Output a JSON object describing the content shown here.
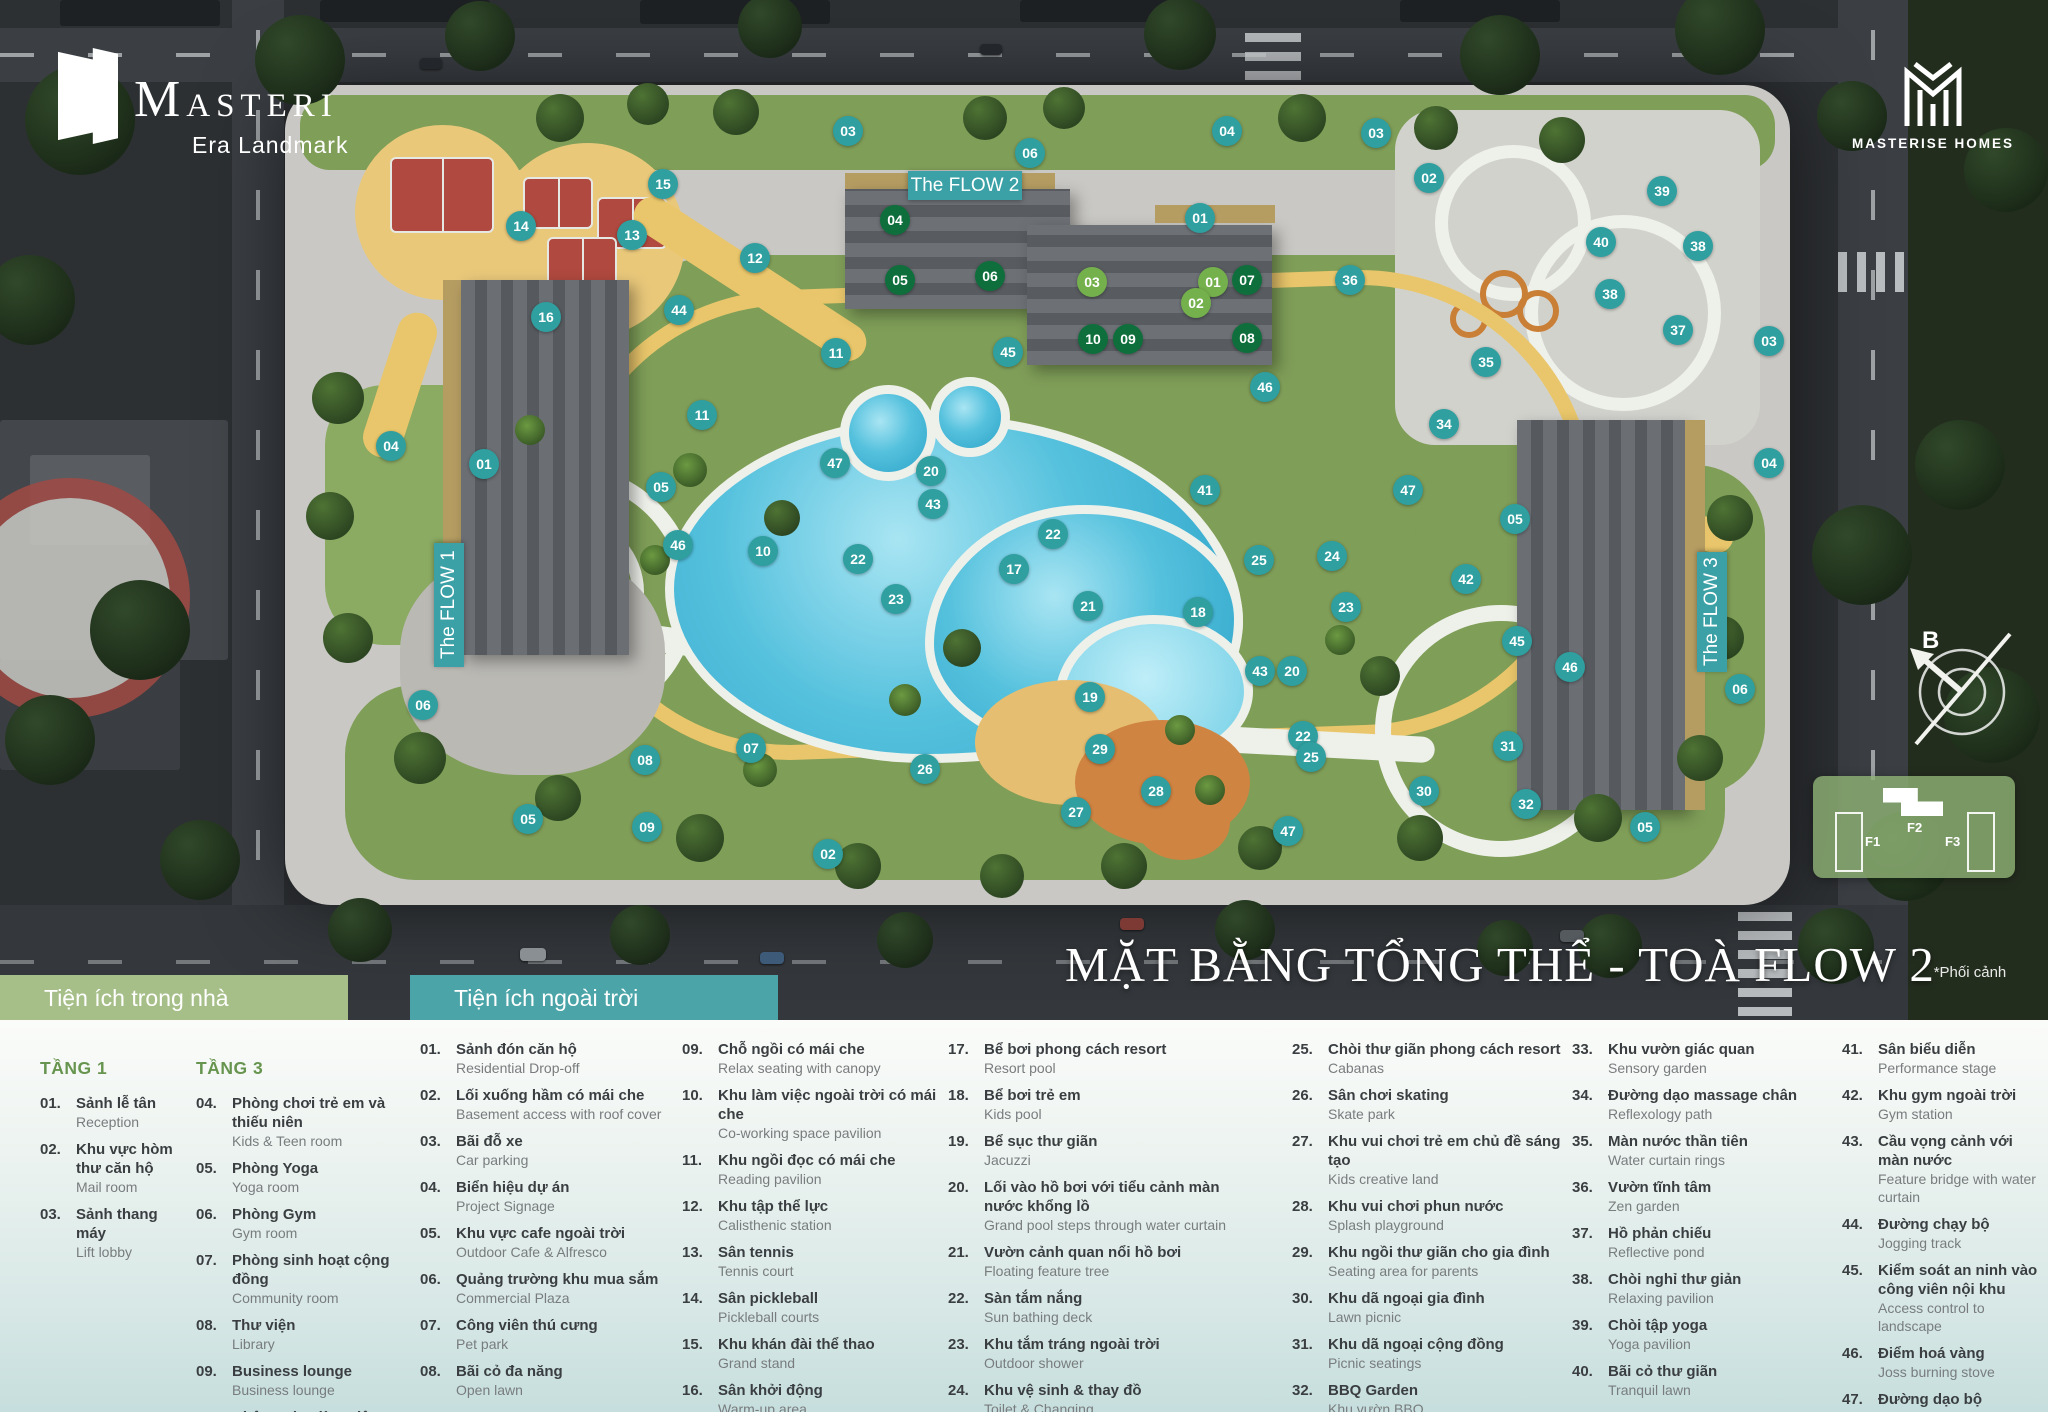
{
  "branding": {
    "logo_title": "MASTERI",
    "logo_subtitle": "Era Landmark",
    "developer": "MASTERISE HOMES"
  },
  "title": "MẶT BẰNG TỔNG THỂ - TOÀ FLOW 2",
  "note": "*Phối cảnh",
  "compass_label": "B",
  "tower_labels": {
    "flow1": "The FLOW 1",
    "flow2": "The FLOW 2",
    "flow3": "The FLOW 3"
  },
  "locator": {
    "f1": "F1",
    "f2": "F2",
    "f3": "F3"
  },
  "colors": {
    "marker_teal": "#2f9fa0",
    "marker_green_floor1": "#74b04c",
    "marker_green_floor3": "#0f6f3c",
    "header_green": "#a6bf88",
    "header_teal": "#4aa4a8"
  },
  "legend": {
    "indoor_header": "Tiện ích trong nhà",
    "outdoor_header": "Tiện ích ngoài trời",
    "floor1_title": "TẦNG 1",
    "floor3_title": "TẦNG 3",
    "floor1_items": [
      {
        "no": "01.",
        "vi": "Sảnh lễ tân",
        "en": "Reception"
      },
      {
        "no": "02.",
        "vi": "Khu vực hòm thư căn hộ",
        "en": "Mail room"
      },
      {
        "no": "03.",
        "vi": "Sảnh thang máy",
        "en": "Lift lobby"
      }
    ],
    "floor3_items": [
      {
        "no": "04.",
        "vi": "Phòng chơi trẻ em và thiếu niên",
        "en": "Kids & Teen room"
      },
      {
        "no": "05.",
        "vi": "Phòng Yoga",
        "en": "Yoga room"
      },
      {
        "no": "06.",
        "vi": "Phòng Gym",
        "en": "Gym room"
      },
      {
        "no": "07.",
        "vi": "Phòng sinh hoạt cộng đồng",
        "en": "Community room"
      },
      {
        "no": "08.",
        "vi": "Thư viện",
        "en": "Library"
      },
      {
        "no": "09.",
        "vi": "Business lounge",
        "en": "Business lounge"
      },
      {
        "no": "10.",
        "vi": "Không gian làm việc",
        "en": "Co-working space"
      }
    ],
    "outdoor_columns": [
      [
        {
          "no": "01.",
          "vi": "Sảnh đón căn hộ",
          "en": "Residential Drop-off"
        },
        {
          "no": "02.",
          "vi": "Lối xuống hầm có mái che",
          "en": "Basement access with roof cover"
        },
        {
          "no": "03.",
          "vi": "Bãi đỗ xe",
          "en": "Car parking"
        },
        {
          "no": "04.",
          "vi": "Biển hiệu dự án",
          "en": "Project Signage"
        },
        {
          "no": "05.",
          "vi": "Khu vực cafe ngoài trời",
          "en": "Outdoor Cafe & Alfresco"
        },
        {
          "no": "06.",
          "vi": "Quảng trường khu mua sắm",
          "en": "Commercial Plaza"
        },
        {
          "no": "07.",
          "vi": "Công viên thú cưng",
          "en": "Pet park"
        },
        {
          "no": "08.",
          "vi": "Bãi cỏ đa năng",
          "en": "Open lawn"
        }
      ],
      [
        {
          "no": "09.",
          "vi": "Chỗ ngồi có mái che",
          "en": "Relax seating with canopy"
        },
        {
          "no": "10.",
          "vi": "Khu làm việc ngoài trời có mái che",
          "en": "Co-working space pavilion"
        },
        {
          "no": "11.",
          "vi": "Khu ngồi đọc có mái che",
          "en": "Reading pavilion"
        },
        {
          "no": "12.",
          "vi": "Khu tập thể lực",
          "en": "Calisthenic station"
        },
        {
          "no": "13.",
          "vi": "Sân tennis",
          "en": "Tennis court"
        },
        {
          "no": "14.",
          "vi": "Sân pickleball",
          "en": "Pickleball courts"
        },
        {
          "no": "15.",
          "vi": "Khu khán đài thể thao",
          "en": "Grand stand"
        },
        {
          "no": "16.",
          "vi": "Sân khởi động",
          "en": "Warm-up area"
        }
      ],
      [
        {
          "no": "17.",
          "vi": "Bể bơi phong cách resort",
          "en": "Resort pool"
        },
        {
          "no": "18.",
          "vi": "Bể bơi trẻ em",
          "en": "Kids pool"
        },
        {
          "no": "19.",
          "vi": "Bể sục thư giãn",
          "en": "Jacuzzi"
        },
        {
          "no": "20.",
          "vi": "Lối vào hồ bơi với tiểu cảnh màn nước khổng lồ",
          "en": "Grand pool steps through water curtain"
        },
        {
          "no": "21.",
          "vi": "Vườn cảnh quan nổi hồ bơi",
          "en": "Floating feature tree"
        },
        {
          "no": "22.",
          "vi": "Sàn tắm nắng",
          "en": "Sun bathing deck"
        },
        {
          "no": "23.",
          "vi": "Khu tắm tráng ngoài trời",
          "en": "Outdoor shower"
        },
        {
          "no": "24.",
          "vi": "Khu vệ sinh & thay đồ",
          "en": "Toilet & Changing"
        }
      ],
      [
        {
          "no": "25.",
          "vi": "Chòi thư giãn phong cách resort",
          "en": "Cabanas"
        },
        {
          "no": "26.",
          "vi": "Sân chơi skating",
          "en": "Skate park"
        },
        {
          "no": "27.",
          "vi": "Khu vui chơi trẻ em chủ đề sáng tạo",
          "en": "Kids creative land"
        },
        {
          "no": "28.",
          "vi": "Khu vui chơi phun nước",
          "en": "Splash playground"
        },
        {
          "no": "29.",
          "vi": "Khu ngồi thư giãn cho gia đình",
          "en": "Seating area for parents"
        },
        {
          "no": "30.",
          "vi": "Khu dã ngoại gia đình",
          "en": "Lawn picnic"
        },
        {
          "no": "31.",
          "vi": "Khu dã ngoại cộng đồng",
          "en": "Picnic seatings"
        },
        {
          "no": "32.",
          "vi": "BBQ Garden",
          "en": "Khu vườn BBQ"
        }
      ],
      [
        {
          "no": "33.",
          "vi": "Khu vườn giác quan",
          "en": "Sensory garden"
        },
        {
          "no": "34.",
          "vi": "Đường dạo massage chân",
          "en": "Reflexology path"
        },
        {
          "no": "35.",
          "vi": "Màn nước thần tiên",
          "en": "Water curtain rings"
        },
        {
          "no": "36.",
          "vi": "Vườn tĩnh tâm",
          "en": "Zen garden"
        },
        {
          "no": "37.",
          "vi": "Hồ phản chiếu",
          "en": "Reflective pond"
        },
        {
          "no": "38.",
          "vi": "Chòi nghỉ thư giản",
          "en": "Relaxing pavilion"
        },
        {
          "no": "39.",
          "vi": "Chòi tập yoga",
          "en": "Yoga pavilion"
        },
        {
          "no": "40.",
          "vi": "Bãi cỏ thư giãn",
          "en": "Tranquil lawn"
        }
      ],
      [
        {
          "no": "41.",
          "vi": "Sân biểu diễn",
          "en": "Performance stage"
        },
        {
          "no": "42.",
          "vi": "Khu gym ngoài trời",
          "en": "Gym station"
        },
        {
          "no": "43.",
          "vi": "Cầu vọng cảnh với màn nước",
          "en": "Feature bridge with water curtain"
        },
        {
          "no": "44.",
          "vi": "Đường chạy bộ",
          "en": "Jogging track"
        },
        {
          "no": "45.",
          "vi": "Kiểm soát an ninh vào công viên nội khu",
          "en": "Access control to landscape"
        },
        {
          "no": "46.",
          "vi": "Điểm hoá vàng",
          "en": "Joss burning stove"
        },
        {
          "no": "47.",
          "vi": "Đường dạo bộ",
          "en": "Walking path"
        }
      ]
    ]
  },
  "markers": [
    {
      "n": "03",
      "x": 848,
      "y": 131,
      "c": "t"
    },
    {
      "n": "06",
      "x": 1030,
      "y": 153,
      "c": "t"
    },
    {
      "n": "04",
      "x": 1227,
      "y": 131,
      "c": "t"
    },
    {
      "n": "03",
      "x": 1376,
      "y": 133,
      "c": "t"
    },
    {
      "n": "02",
      "x": 1429,
      "y": 178,
      "c": "t"
    },
    {
      "n": "01",
      "x": 1200,
      "y": 218,
      "c": "t"
    },
    {
      "n": "15",
      "x": 663,
      "y": 184,
      "c": "t"
    },
    {
      "n": "14",
      "x": 521,
      "y": 226,
      "c": "t"
    },
    {
      "n": "13",
      "x": 632,
      "y": 235,
      "c": "t"
    },
    {
      "n": "12",
      "x": 755,
      "y": 258,
      "c": "t"
    },
    {
      "n": "16",
      "x": 546,
      "y": 317,
      "c": "t"
    },
    {
      "n": "44",
      "x": 679,
      "y": 310,
      "c": "t"
    },
    {
      "n": "36",
      "x": 1350,
      "y": 280,
      "c": "t"
    },
    {
      "n": "39",
      "x": 1662,
      "y": 191,
      "c": "t"
    },
    {
      "n": "40",
      "x": 1601,
      "y": 242,
      "c": "t"
    },
    {
      "n": "38",
      "x": 1698,
      "y": 246,
      "c": "t"
    },
    {
      "n": "38",
      "x": 1610,
      "y": 294,
      "c": "t"
    },
    {
      "n": "37",
      "x": 1678,
      "y": 330,
      "c": "t"
    },
    {
      "n": "03",
      "x": 1769,
      "y": 341,
      "c": "t"
    },
    {
      "n": "35",
      "x": 1486,
      "y": 362,
      "c": "t"
    },
    {
      "n": "34",
      "x": 1444,
      "y": 424,
      "c": "t"
    },
    {
      "n": "04",
      "x": 1769,
      "y": 463,
      "c": "t"
    },
    {
      "n": "11",
      "x": 836,
      "y": 353,
      "c": "t"
    },
    {
      "n": "11",
      "x": 702,
      "y": 415,
      "c": "t"
    },
    {
      "n": "45",
      "x": 1008,
      "y": 352,
      "c": "t"
    },
    {
      "n": "46",
      "x": 1265,
      "y": 387,
      "c": "t"
    },
    {
      "n": "04",
      "x": 391,
      "y": 446,
      "c": "t"
    },
    {
      "n": "01",
      "x": 484,
      "y": 464,
      "c": "t"
    },
    {
      "n": "05",
      "x": 661,
      "y": 487,
      "c": "t"
    },
    {
      "n": "47",
      "x": 835,
      "y": 463,
      "c": "t"
    },
    {
      "n": "20",
      "x": 931,
      "y": 471,
      "c": "t"
    },
    {
      "n": "43",
      "x": 933,
      "y": 504,
      "c": "t"
    },
    {
      "n": "41",
      "x": 1205,
      "y": 490,
      "c": "t"
    },
    {
      "n": "47",
      "x": 1408,
      "y": 490,
      "c": "t"
    },
    {
      "n": "05",
      "x": 1515,
      "y": 519,
      "c": "t"
    },
    {
      "n": "46",
      "x": 678,
      "y": 545,
      "c": "t"
    },
    {
      "n": "10",
      "x": 763,
      "y": 551,
      "c": "t"
    },
    {
      "n": "22",
      "x": 858,
      "y": 559,
      "c": "t"
    },
    {
      "n": "22",
      "x": 1053,
      "y": 534,
      "c": "t"
    },
    {
      "n": "17",
      "x": 1014,
      "y": 569,
      "c": "t"
    },
    {
      "n": "25",
      "x": 1259,
      "y": 560,
      "c": "t"
    },
    {
      "n": "24",
      "x": 1332,
      "y": 556,
      "c": "t"
    },
    {
      "n": "42",
      "x": 1466,
      "y": 579,
      "c": "t"
    },
    {
      "n": "23",
      "x": 896,
      "y": 599,
      "c": "t"
    },
    {
      "n": "21",
      "x": 1088,
      "y": 606,
      "c": "t"
    },
    {
      "n": "18",
      "x": 1198,
      "y": 612,
      "c": "t"
    },
    {
      "n": "23",
      "x": 1346,
      "y": 607,
      "c": "t"
    },
    {
      "n": "45",
      "x": 1517,
      "y": 641,
      "c": "t"
    },
    {
      "n": "46",
      "x": 1570,
      "y": 667,
      "c": "t"
    },
    {
      "n": "43",
      "x": 1260,
      "y": 671,
      "c": "t"
    },
    {
      "n": "20",
      "x": 1292,
      "y": 671,
      "c": "t"
    },
    {
      "n": "19",
      "x": 1090,
      "y": 697,
      "c": "t"
    },
    {
      "n": "06",
      "x": 423,
      "y": 705,
      "c": "t"
    },
    {
      "n": "06",
      "x": 1740,
      "y": 689,
      "c": "t"
    },
    {
      "n": "31",
      "x": 1508,
      "y": 746,
      "c": "t"
    },
    {
      "n": "07",
      "x": 751,
      "y": 748,
      "c": "t"
    },
    {
      "n": "08",
      "x": 645,
      "y": 760,
      "c": "t"
    },
    {
      "n": "26",
      "x": 925,
      "y": 769,
      "c": "t"
    },
    {
      "n": "29",
      "x": 1100,
      "y": 749,
      "c": "t"
    },
    {
      "n": "22",
      "x": 1303,
      "y": 736,
      "c": "t"
    },
    {
      "n": "25",
      "x": 1311,
      "y": 757,
      "c": "t"
    },
    {
      "n": "30",
      "x": 1424,
      "y": 791,
      "c": "t"
    },
    {
      "n": "32",
      "x": 1526,
      "y": 804,
      "c": "t"
    },
    {
      "n": "28",
      "x": 1156,
      "y": 791,
      "c": "t"
    },
    {
      "n": "27",
      "x": 1076,
      "y": 812,
      "c": "t"
    },
    {
      "n": "47",
      "x": 1288,
      "y": 831,
      "c": "t"
    },
    {
      "n": "09",
      "x": 647,
      "y": 827,
      "c": "t"
    },
    {
      "n": "05",
      "x": 528,
      "y": 819,
      "c": "t"
    },
    {
      "n": "02",
      "x": 828,
      "y": 854,
      "c": "t"
    },
    {
      "n": "05",
      "x": 1645,
      "y": 827,
      "c": "t"
    },
    {
      "n": "03",
      "x": 1092,
      "y": 282,
      "c": "g"
    },
    {
      "n": "01",
      "x": 1213,
      "y": 282,
      "c": "g"
    },
    {
      "n": "02",
      "x": 1196,
      "y": 303,
      "c": "g"
    },
    {
      "n": "04",
      "x": 895,
      "y": 220,
      "c": "d"
    },
    {
      "n": "05",
      "x": 900,
      "y": 280,
      "c": "d"
    },
    {
      "n": "06",
      "x": 990,
      "y": 276,
      "c": "d"
    },
    {
      "n": "07",
      "x": 1247,
      "y": 280,
      "c": "d"
    },
    {
      "n": "10",
      "x": 1093,
      "y": 339,
      "c": "d"
    },
    {
      "n": "09",
      "x": 1128,
      "y": 339,
      "c": "d"
    },
    {
      "n": "08",
      "x": 1247,
      "y": 338,
      "c": "d"
    }
  ]
}
